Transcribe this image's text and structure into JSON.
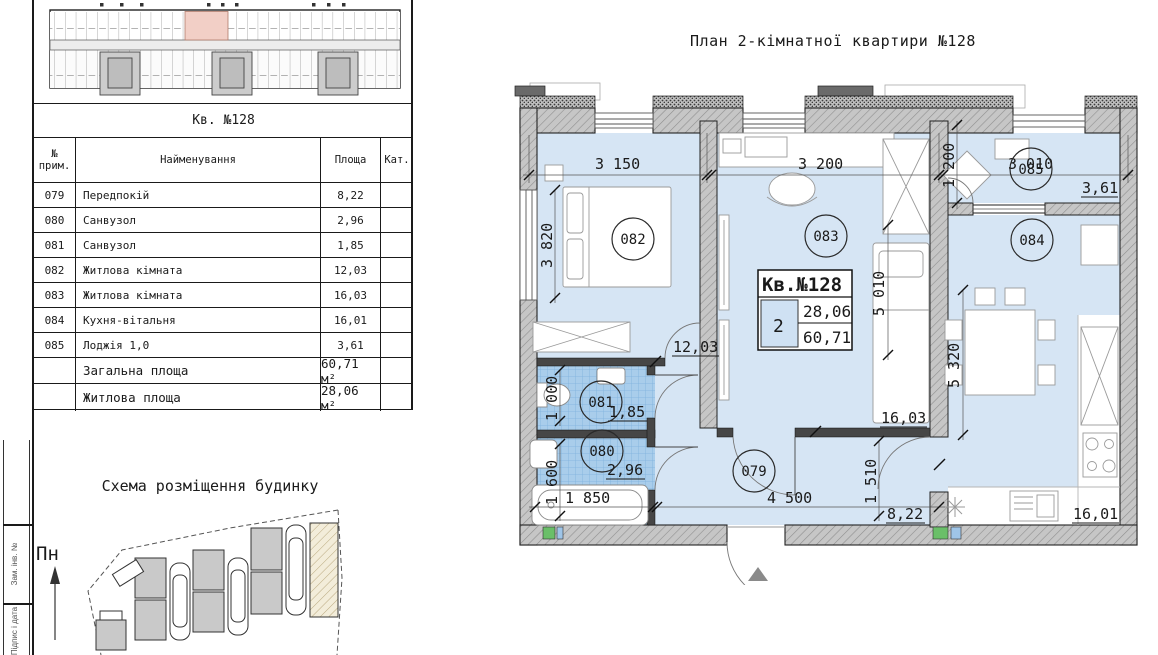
{
  "plan": {
    "title": "План 2-кімнатної квартири №128",
    "info": {
      "title": "Кв.№128",
      "rooms_count": "2",
      "living_area": "28,06",
      "total_area": "60,71"
    },
    "rooms": {
      "hall": {
        "label": "079",
        "area": "8,22"
      },
      "bath1": {
        "label": "080",
        "area": "2,96"
      },
      "bath2": {
        "label": "081",
        "area": "1,85"
      },
      "bedroom1": {
        "label": "082",
        "area": "12,03"
      },
      "bedroom2": {
        "label": "083",
        "area": "16,03"
      },
      "kitchen": {
        "label": "084",
        "area": "16,01"
      },
      "loggia": {
        "label": "085",
        "area": "3,61"
      }
    },
    "dims": {
      "w1": "3 150",
      "w2": "3 200",
      "w3": "3 010",
      "loggia_d": "1 200",
      "bed1_d": "3 820",
      "bed2_d": "5 010",
      "kitchen_d": "5 320",
      "bath2_d": "1 000",
      "bath1_d": "1 600",
      "hall_d": "1 510",
      "bath_w": "1 850",
      "hall_w": "4 500"
    }
  },
  "table": {
    "title": "Кв. №128",
    "headers": {
      "num": "№\nприм.",
      "name": "Найменування",
      "area": "Площа",
      "cat": "Кат."
    },
    "rows": [
      {
        "num": "079",
        "name": "Передпокій",
        "area": "8,22"
      },
      {
        "num": "080",
        "name": "Санвузол",
        "area": "2,96"
      },
      {
        "num": "081",
        "name": "Санвузол",
        "area": "1,85"
      },
      {
        "num": "082",
        "name": "Житлова кімната",
        "area": "12,03"
      },
      {
        "num": "083",
        "name": "Житлова кімната",
        "area": "16,03"
      },
      {
        "num": "084",
        "name": "Кухня-вітальня",
        "area": "16,01"
      },
      {
        "num": "085",
        "name": "Лоджія 1,0",
        "area": "3,61"
      }
    ],
    "totals": [
      {
        "name": "Загальна площа",
        "area": "60,71 м²"
      },
      {
        "name": "Житлова площа",
        "area": "28,06 м²"
      }
    ]
  },
  "site": {
    "title": "Схема розміщення будинку",
    "north": "Пн"
  },
  "stamp": {
    "labels": [
      "Зам. інв. №",
      "Підпис і дата"
    ]
  },
  "colors": {
    "floor": "#d6e5f4",
    "tile": "#a9cdeb",
    "wall": "#c6c6c6",
    "highlight_unit": "#f2cfc6",
    "marker_green": "#6abf69",
    "marker_blue": "#9fc5e8"
  }
}
